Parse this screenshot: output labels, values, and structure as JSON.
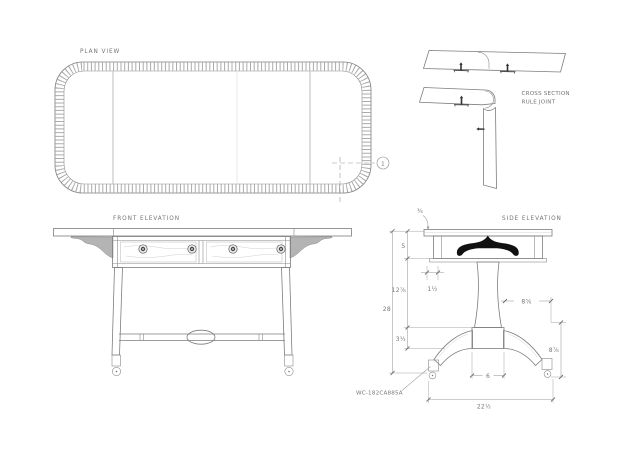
{
  "drawing": {
    "labels": {
      "plan": "PLAN VIEW",
      "front": "FRONT ELEVATION",
      "side": "SIDE ELEVATION",
      "section_line1": "CROSS SECTION",
      "section_line2": "RULE JOINT"
    },
    "part_number": "WC-182CA885A",
    "detail_marker": "1",
    "dimensions": {
      "top_thickness": "¾",
      "apron_height": "5",
      "apron_thickness": "1½",
      "pedestal_height": "12⅞",
      "overall_height": "28",
      "base_height": "3½",
      "leg_spread": "8⅝",
      "leg_height": "8⅞",
      "base_width": "6",
      "overall_depth": "22½"
    },
    "colors": {
      "line": "#7d7d7d",
      "dim_line": "#9a9a9a",
      "text": "#767676",
      "leaf_support_fill": "#111111",
      "bracket_fill": "#b4b4b4",
      "grain": "#b9b9b9"
    }
  }
}
